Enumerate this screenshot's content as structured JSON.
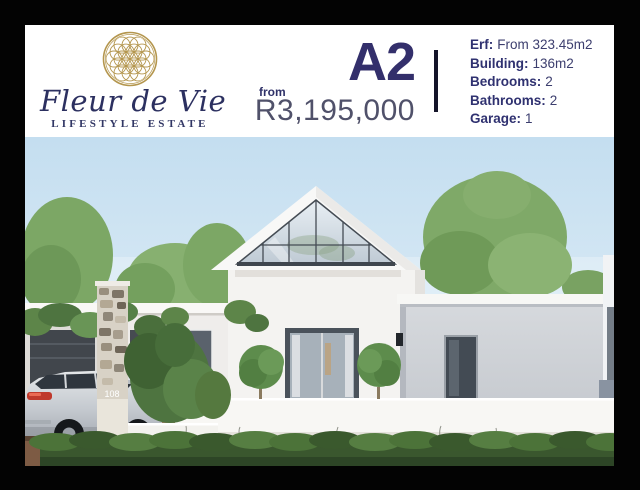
{
  "header": {
    "logo": {
      "name": "Fleur de Vie",
      "tagline": "LIFESTYLE ESTATE",
      "emblem": "flower-of-life-icon"
    },
    "plan_code": "A2",
    "price_prefix": "from",
    "price": "R3,195,000",
    "specs": [
      {
        "label": "Erf:",
        "value": "From 323.45m2"
      },
      {
        "label": "Building:",
        "value": "136m2"
      },
      {
        "label": "Bedrooms:",
        "value": "2"
      },
      {
        "label": "Bathrooms:",
        "value": "2"
      },
      {
        "label": "Garage:",
        "value": "1"
      }
    ]
  },
  "photo": {
    "house_number": "108",
    "description": "Architect render of a modern single-storey estate home with glass gable, stone pillar, boxwood hedge and parked silver SUV"
  },
  "colors": {
    "frame_black": "#030303",
    "accent_navy": "#2f3170",
    "price_grey_navy": "#50516a",
    "logo_gold": "#b4964e",
    "sky_blue": "#c9e1f1",
    "hedge_green": "#3a582f",
    "wall_white": "#f4f3f1",
    "wing_grey": "#c9cdd3"
  }
}
